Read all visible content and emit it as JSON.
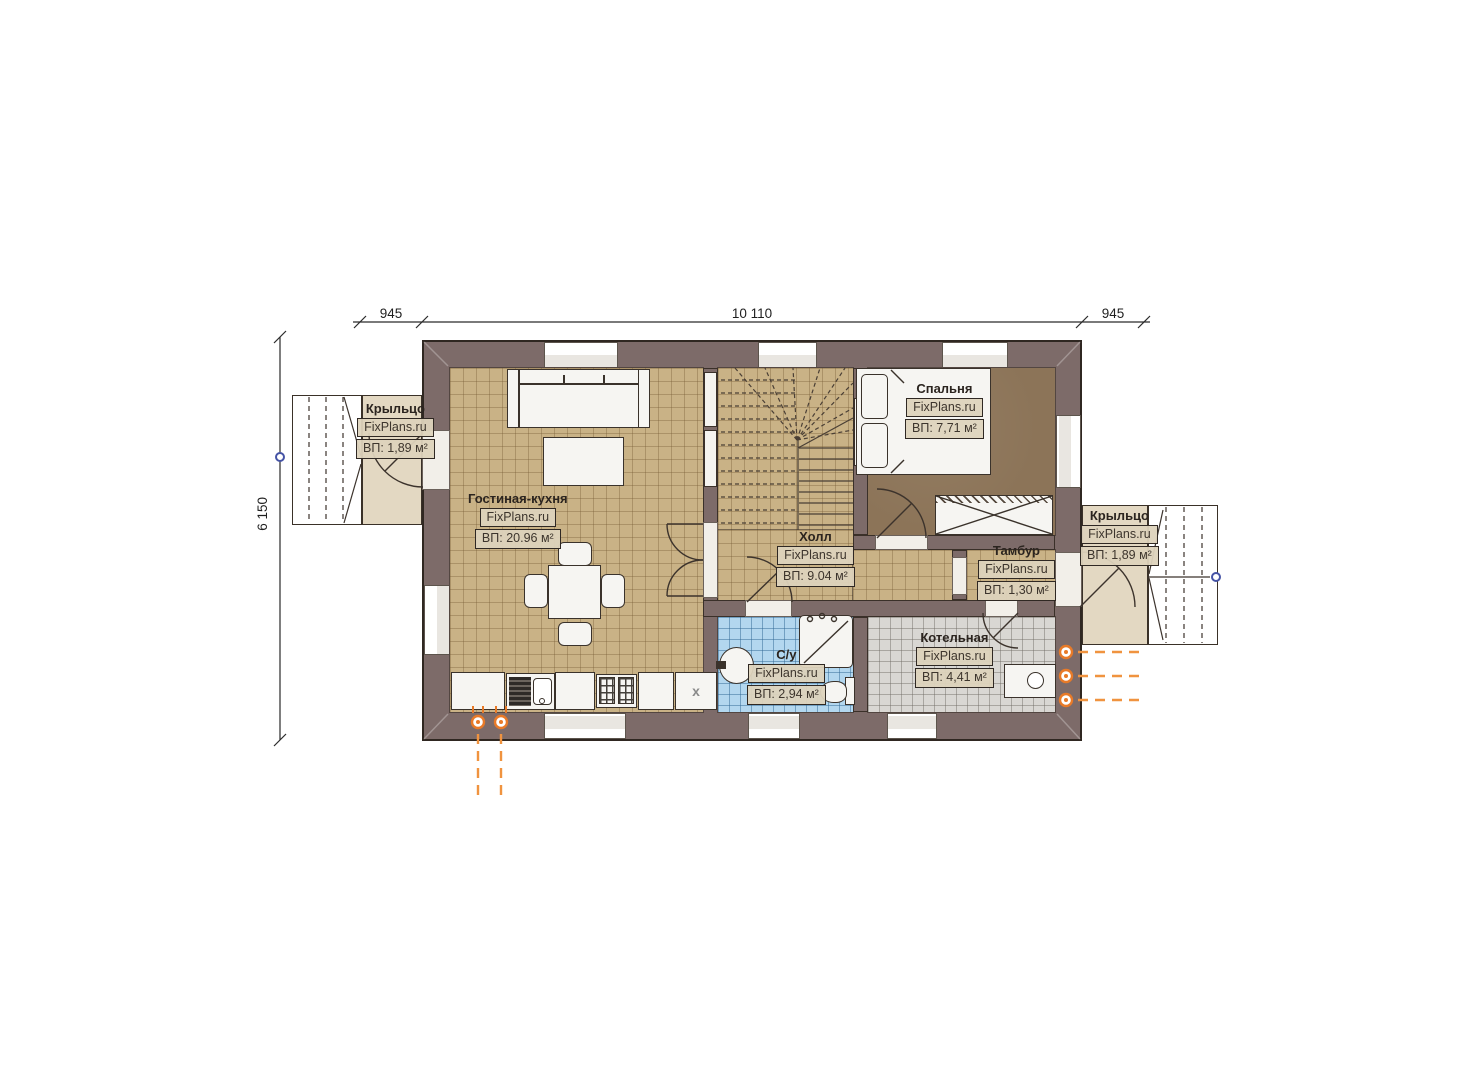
{
  "dimensions": {
    "top_left": "945",
    "top_center": "10 110",
    "top_right": "945",
    "left_height": "6 150"
  },
  "rooms": {
    "porch_left": {
      "name": "Крыльцо",
      "brand": "FixPlans.ru",
      "area": "ВП: 1,89 м²"
    },
    "living_kitchen": {
      "name": "Гостиная-кухня",
      "brand": "FixPlans.ru",
      "area": "ВП: 20.96 м²"
    },
    "hall": {
      "name": "Холл",
      "brand": "FixPlans.ru",
      "area": "ВП: 9.04 м²"
    },
    "bedroom": {
      "name": "Спальня",
      "brand": "FixPlans.ru",
      "area": "ВП: 7,71 м²"
    },
    "vestibule": {
      "name": "Тамбур",
      "brand": "FixPlans.ru",
      "area": "ВП: 1,30 м²"
    },
    "bathroom": {
      "name": "С/у",
      "brand": "FixPlans.ru",
      "area": "ВП: 2,94 м²"
    },
    "boiler": {
      "name": "Котельная",
      "brand": "FixPlans.ru",
      "area": "ВП: 4,41 м²"
    },
    "porch_right": {
      "name": "Крыльцо",
      "brand": "FixPlans.ru",
      "area": "ВП: 1,89 м²"
    }
  },
  "symbols": {
    "vent_label": "x"
  },
  "colors": {
    "wall": "#7d6b69",
    "floor_tan": "#c9b286",
    "floor_brown": "#8c7458",
    "floor_blue": "#b3d7ef",
    "floor_gray": "#d9d7d3",
    "floor_porch": "#e3d8c2",
    "accent_orange": "#ed7d31",
    "node_blue": "#4553a5"
  }
}
